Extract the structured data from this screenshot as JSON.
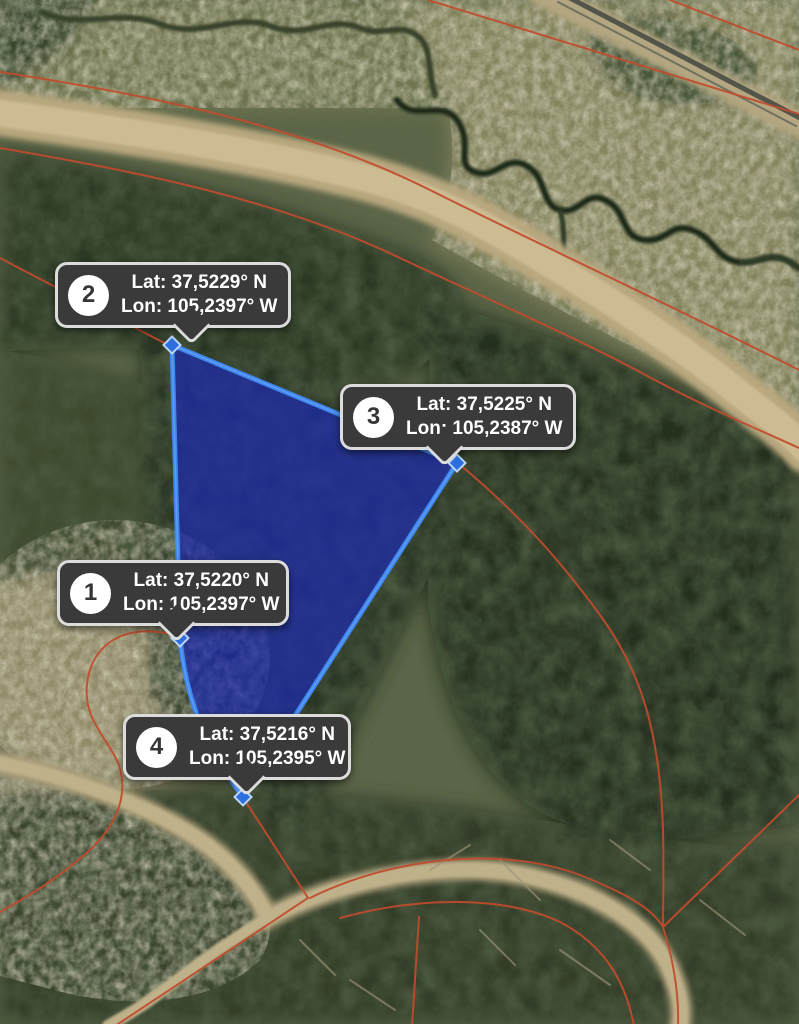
{
  "map": {
    "kind": "satellite-parcel-view",
    "colors": {
      "parcel_fill": "#1e2ba8",
      "parcel_stroke": "#3e86ef",
      "boundary_line": "#c24b2d",
      "tooltip_bg": "#3a3a3a",
      "tooltip_border": "#dcdcdc"
    }
  },
  "markers": [
    {
      "number": "1",
      "lat": "Lat: 37,5220° N",
      "lon": "Lon: 105,2397° W"
    },
    {
      "number": "2",
      "lat": "Lat: 37,5229° N",
      "lon": "Lon: 105,2397° W"
    },
    {
      "number": "3",
      "lat": "Lat: 37,5225° N",
      "lon": "Lon: 105,2387° W"
    },
    {
      "number": "4",
      "lat": "Lat: 37,5216° N",
      "lon": "Lon: 105,2395° W"
    }
  ]
}
